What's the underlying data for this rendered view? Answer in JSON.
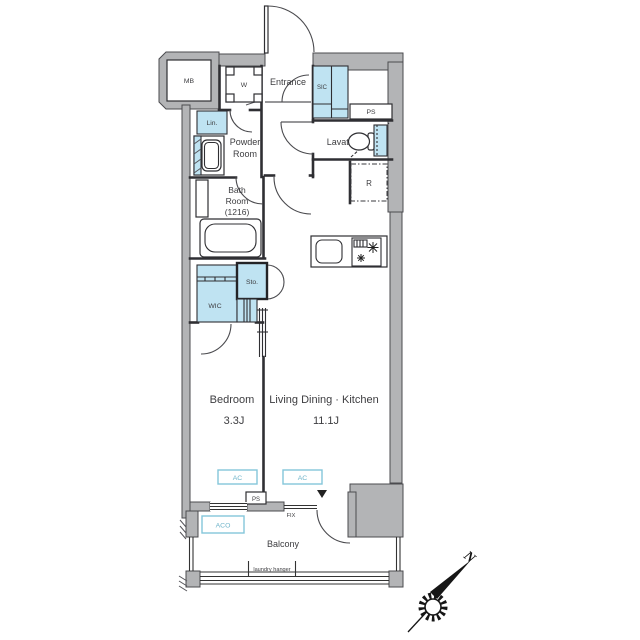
{
  "title": "1K apartment floor plan",
  "labels": {
    "mb": "MB",
    "w": "W",
    "entrance": "Entrance",
    "sic": "SIC",
    "ps_top": "PS",
    "lin": "Lin.",
    "powder1": "Powder",
    "powder2": "Room",
    "lavatory": "Lavatory",
    "bath1": "Bath",
    "bath2": "Room",
    "bath3": "(1216)",
    "fridge": "R",
    "sto": "Sto.",
    "wic": "WIC",
    "bedroom": "Bedroom",
    "bedroom_size": "3.3J",
    "ldk": "Living Dining · Kitchen",
    "ldk_size": "11.1J",
    "ac": "AC",
    "ps_bottom": "PS",
    "fix": "FIX",
    "aco": "ACO",
    "balcony": "Balcony",
    "laundry": "laundry hanger",
    "north": "N"
  },
  "colors": {
    "wall_gray": "#b3b4b6",
    "fixture_blue": "#bfe3f2",
    "accent_blue_border": "#84c6da",
    "accent_blue_text": "#6fb4ca",
    "line": "#2f2f33"
  }
}
